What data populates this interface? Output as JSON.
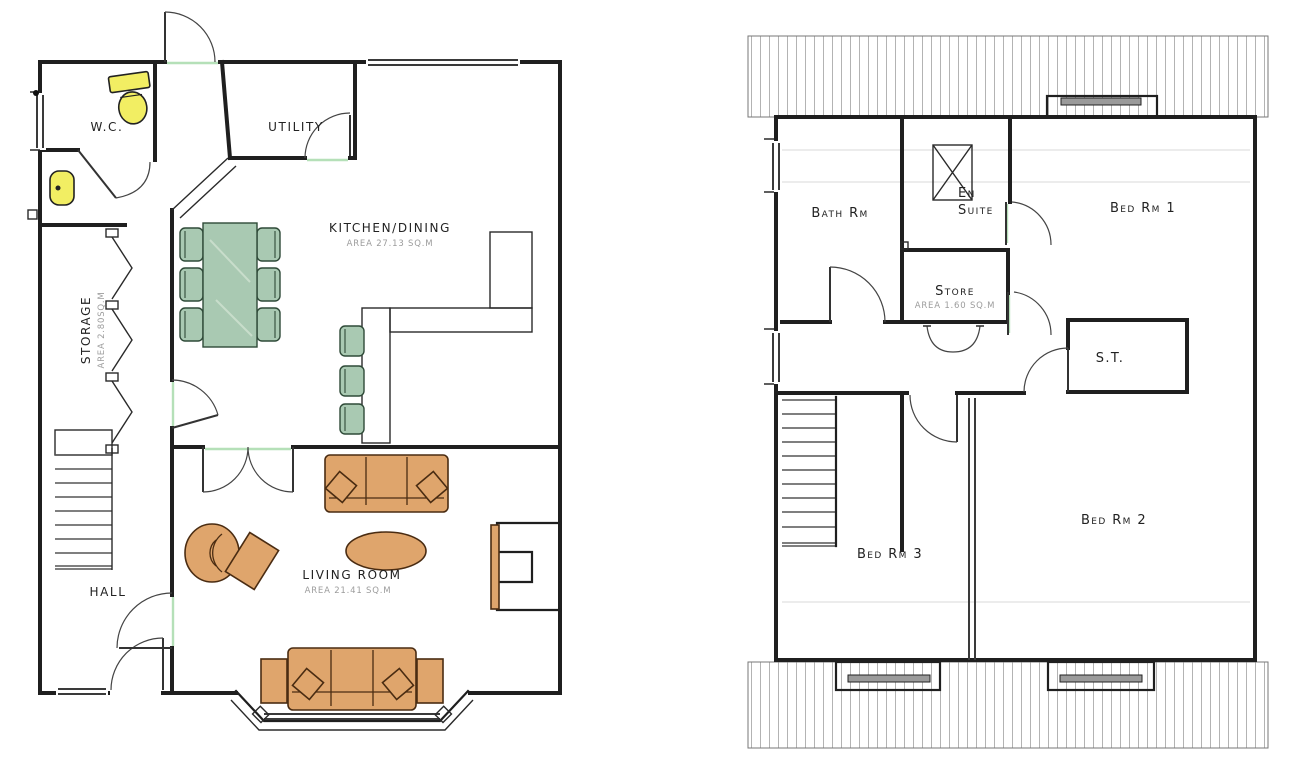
{
  "title": "House floor plans",
  "colors": {
    "wall": "#1f1f1f",
    "furniture_tan": "#dfa56c",
    "furniture_green": "#a9c9b2",
    "fixture_yellow": "#f2ee63",
    "threshold_green": "#b5e0b8",
    "label_text": "#222222",
    "area_text": "#9c9c9c",
    "hatch": "#b3b3b3"
  },
  "ground_floor": {
    "name": "ground-floor-plan",
    "rooms": [
      {
        "id": "wc",
        "label": "W.C."
      },
      {
        "id": "utility",
        "label": "UTILITY"
      },
      {
        "id": "kitchen",
        "label": "KITCHEN/DINING",
        "area": "AREA 27.13 SQ.M"
      },
      {
        "id": "storage",
        "label": "STORAGE",
        "area": "AREA 2.80SQ.M"
      },
      {
        "id": "hall",
        "label": "HALL"
      },
      {
        "id": "living",
        "label": "LIVING ROOM",
        "area": "AREA 21.41 SQ.M"
      }
    ]
  },
  "first_floor": {
    "name": "first-floor-plan",
    "rooms": [
      {
        "id": "bath",
        "label": "Bath Rm"
      },
      {
        "id": "ensuite",
        "label": "En Suite",
        "label_lines": [
          "En",
          "Suite"
        ]
      },
      {
        "id": "bed1",
        "label": "Bed Rm 1"
      },
      {
        "id": "store",
        "label": "Store",
        "area": "AREA 1.60 SQ.M"
      },
      {
        "id": "st",
        "label": "S.T."
      },
      {
        "id": "bed3",
        "label": "Bed Rm 3"
      },
      {
        "id": "bed2",
        "label": "Bed Rm 2"
      }
    ]
  }
}
